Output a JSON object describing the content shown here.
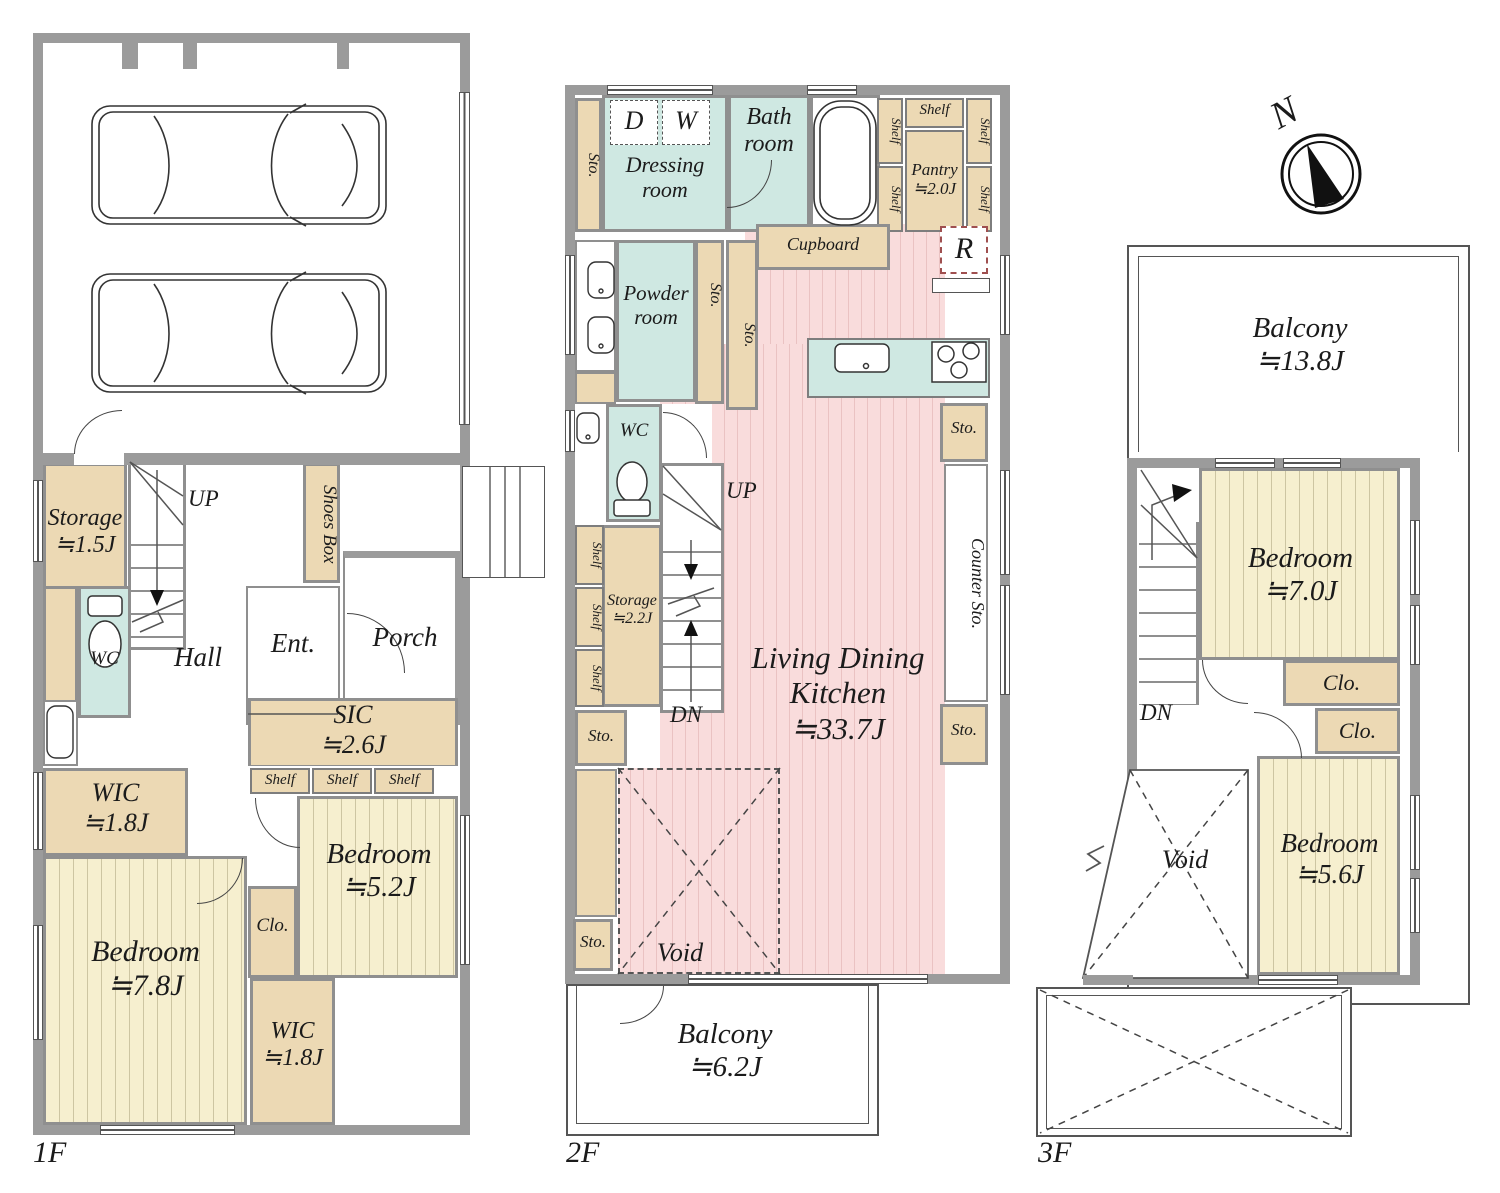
{
  "palette": {
    "wall": "#9b9b9b",
    "tan": "#ecd9b4",
    "teal": "#cfe8e2",
    "bedroom_yellow": "#f6efcf",
    "ldk_pink": "#f9dcdc",
    "line": "#555555",
    "fridge_dash": "#9f4f4f"
  },
  "compass": {
    "north": "N"
  },
  "floors": {
    "f1": {
      "tag": "1F",
      "storage": {
        "name": "Storage",
        "size": "≒1.5J"
      },
      "up": "UP",
      "shoes_box": "Shoes Box",
      "wc": "WC",
      "hall": "Hall",
      "ent": "Ent.",
      "porch": "Porch",
      "sic": {
        "name": "SIC",
        "size": "≒2.6J"
      },
      "shelf": "Shelf",
      "bedroom_a": {
        "name": "Bedroom",
        "size": "≒5.2J"
      },
      "clo": "Clo.",
      "wic_a": {
        "name": "WIC",
        "size": "≒1.8J"
      },
      "bedroom_b": {
        "name": "Bedroom",
        "size": "≒7.8J"
      },
      "wic_b": {
        "name": "WIC",
        "size": "≒1.8J"
      }
    },
    "f2": {
      "tag": "2F",
      "sto": "Sto.",
      "dressing": {
        "line1": "Dressing",
        "line2": "room",
        "d": "D",
        "w": "W"
      },
      "bath": {
        "line1": "Bath",
        "line2": "room"
      },
      "shelf": "Shelf",
      "pantry": {
        "name": "Pantry",
        "size": "≒2.0J"
      },
      "powder": {
        "line1": "Powder",
        "line2": "room"
      },
      "cupboard": "Cupboard",
      "fridge": "R",
      "wc": "WC",
      "up": "UP",
      "dn": "DN",
      "storage": {
        "name": "Storage",
        "size": "≒2.2J"
      },
      "ldk": {
        "line1": "Living Dining",
        "line2": "Kitchen",
        "size": "≒33.7J"
      },
      "counter_sto": "Counter Sto.",
      "void": "Void",
      "balcony": {
        "name": "Balcony",
        "size": "≒6.2J"
      }
    },
    "f3": {
      "tag": "3F",
      "balcony": {
        "name": "Balcony",
        "size": "≒13.8J"
      },
      "dn": "DN",
      "bedroom_a": {
        "name": "Bedroom",
        "size": "≒7.0J"
      },
      "clo": "Clo.",
      "bedroom_b": {
        "name": "Bedroom",
        "size": "≒5.6J"
      },
      "void": "Void"
    }
  }
}
